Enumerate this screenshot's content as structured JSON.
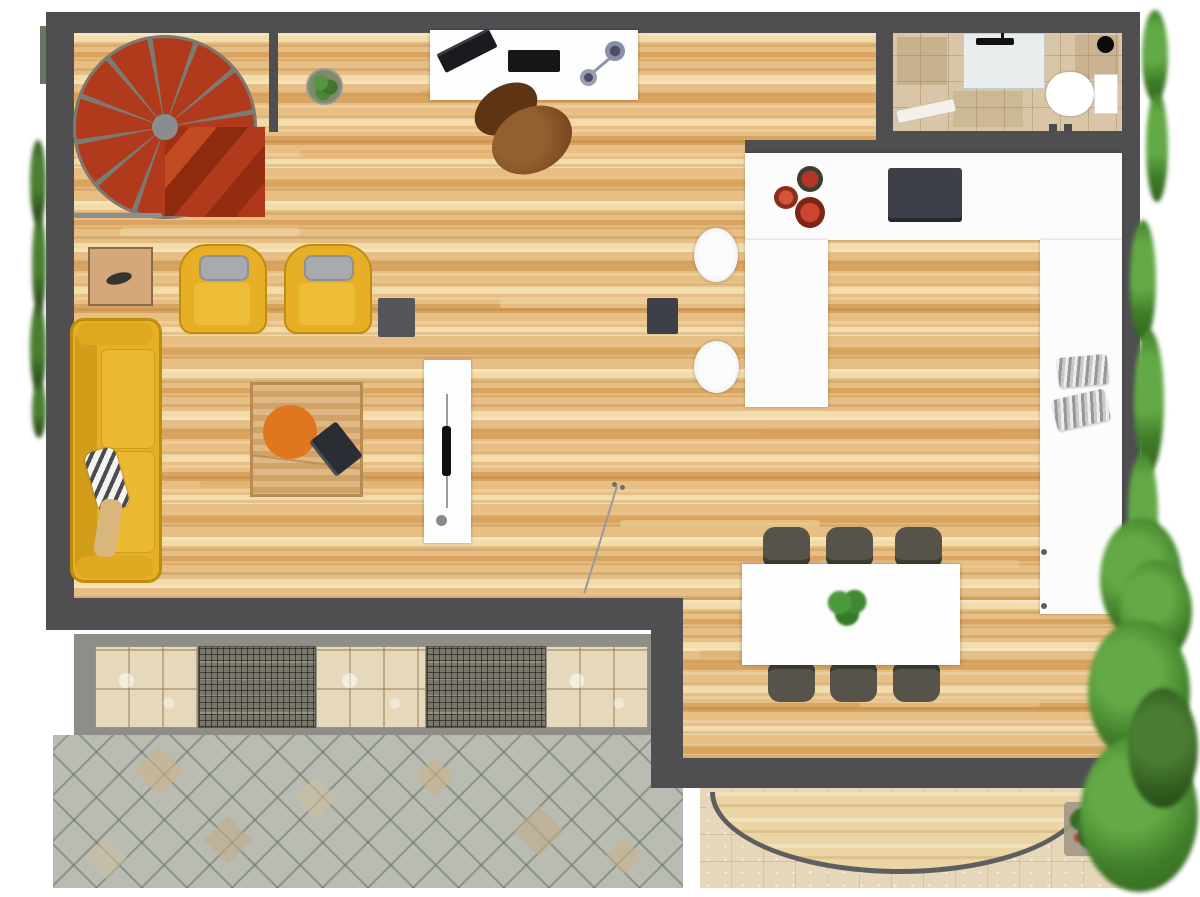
{
  "scene": {
    "kind": "apartment-floor-plan",
    "view": "top-down",
    "canvas": {
      "width": 1200,
      "height": 897
    },
    "visible_text": "none"
  },
  "palette": {
    "wall": "#4f4f52",
    "wood": "#e7bf85",
    "wood-light": "#f2dcab",
    "wood-dark": "#d9a45f",
    "deck": "#ecd5a4",
    "counter": "#fcfcfc",
    "stair-red": "#b23a1c",
    "spoke": "#7d7a72",
    "sofa-yellow": "#e6af26",
    "cushion-gray": "#a7abb0",
    "office-chair-brown": "#7a4824",
    "dining-chair": "#56544a",
    "plant-green": "#3f8f3a",
    "orange": "#e0771f",
    "red-plate": "#bc3d28",
    "dark-item": "#3d4049",
    "gray-item": "#55565c",
    "bath-tile": "#d9c6a7",
    "tile-beige": "#e6d8bb",
    "pav-gray": "#b9bcb2",
    "pav-beige": "#e7d7ba",
    "curve": "#5c5e60"
  },
  "rooms": {
    "living_room": {
      "floor": "hardwood-planks",
      "items": [
        "spiral-staircase",
        "railing",
        "partition-wall",
        "potted-plant",
        "desk",
        "laptop",
        "keyboard",
        "desk-lamp",
        "office-chair",
        "side-table",
        "lounge-chair",
        "lounge-chair",
        "side-cube",
        "sofa",
        "striped-pillow",
        "throw-blanket",
        "coffee-table",
        "round-orange-rug",
        "tablet",
        "tv-sideboard",
        "tv",
        "floor-lamp",
        "speaker-cube"
      ]
    },
    "kitchen": {
      "floor": "hardwood-planks",
      "items": [
        "u-shaped-counter",
        "cooktop",
        "plate-stack",
        "plate-stack",
        "plate-stack",
        "bar-stool",
        "bar-stool",
        "metal-canister",
        "metal-canister",
        "cabinet-handles"
      ]
    },
    "dining_area": {
      "floor": "hardwood-planks",
      "items": [
        "dining-table",
        "centerpiece-plant"
      ],
      "chair_count": 6
    },
    "bathroom": {
      "floor": "ceramic-tile",
      "items": [
        "vanity-sink",
        "faucet",
        "toilet",
        "ceiling-spot",
        "towel",
        "door-pivots"
      ]
    },
    "patio_left": {
      "floor": "diamond-stone-paving",
      "items": [
        "tile-border-band",
        "marble-tile",
        "grate-tile",
        "marble-tile",
        "grate-tile",
        "marble-tile"
      ]
    },
    "terrace_right": {
      "floor": "beige-stone-tiles",
      "items": [
        "semicircular-wood-deck",
        "flower-planter"
      ]
    },
    "landscaping": [
      "hedge-left",
      "hedge-right-top",
      "hedge-right-middle",
      "tree-bottom-right"
    ]
  }
}
